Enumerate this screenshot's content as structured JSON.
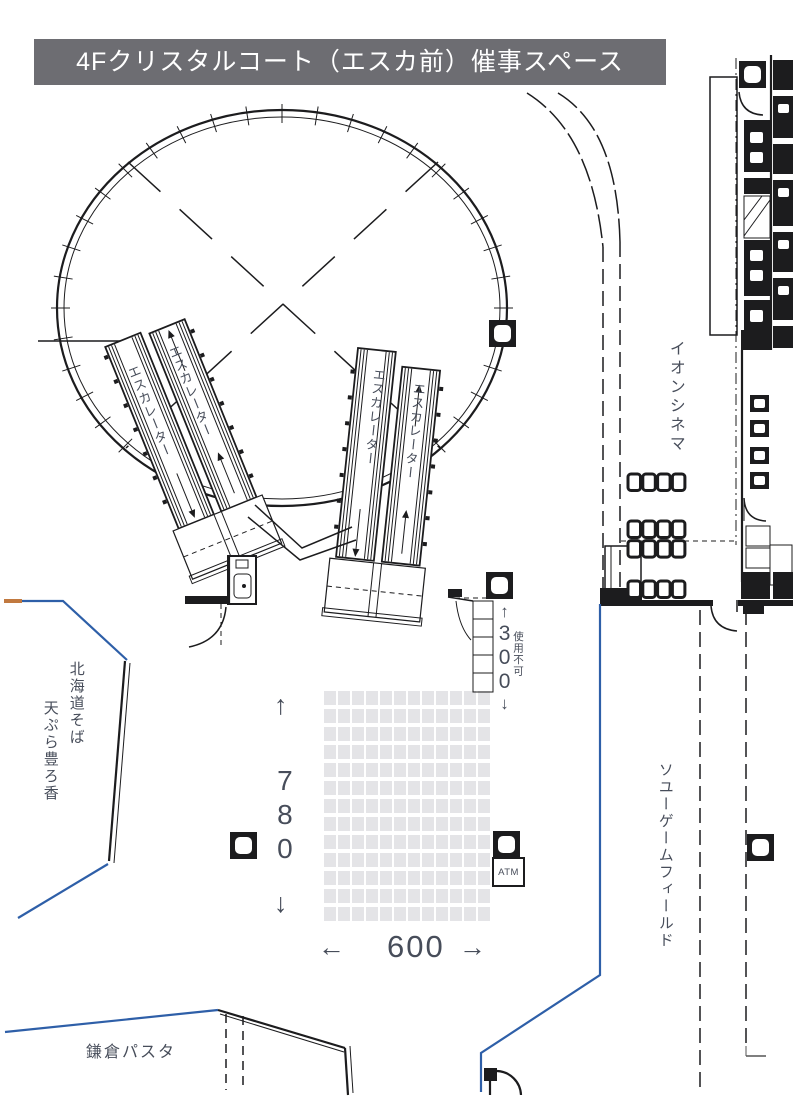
{
  "title": "4Fクリスタルコート（エスカ前）催事スペース",
  "labels": {
    "escalator": "エスカレーター",
    "aeon_cinema": "イオンシネマ",
    "soyu_game_field": "ソユーゲームフィールド",
    "hokkaido_soba": "北海道そば",
    "tempura_horoka": "天ぷら豊ろ香",
    "kamakura_pasta": "鎌倉パスタ",
    "atm": "ATM",
    "unusable": "使用不可"
  },
  "dimensions": {
    "depth": {
      "arrow_up": "↑",
      "value": "780",
      "arrow_down": "↓"
    },
    "width": {
      "arrow_left": "←",
      "value": "600",
      "arrow_right": "→"
    },
    "side": {
      "arrow_up": "↑",
      "value": "300",
      "arrow_down": "↓"
    }
  },
  "grid": {
    "columns": 12,
    "rows": 13
  },
  "colors": {
    "line": "#1c1c1e",
    "boundary_blue": "#2e5fa8",
    "accent_orange": "#c1793f",
    "grid_fill": "#e4e4e7",
    "text": "#474d5a",
    "banner_bg": "#6d6d72"
  }
}
